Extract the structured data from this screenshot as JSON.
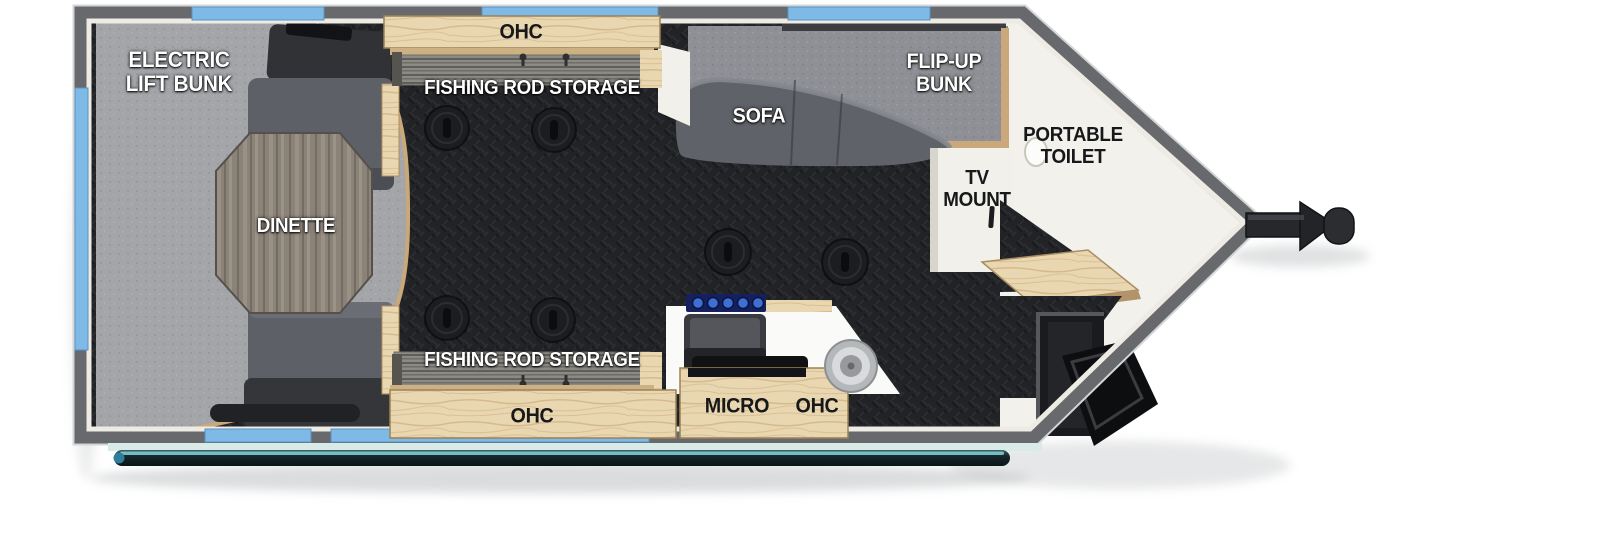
{
  "meta": {
    "type": "rv-floorplan",
    "description": "Top-down floor plan of a V-nose fish house travel trailer with hitch at right"
  },
  "labels": {
    "electric_lift_bunk": {
      "line1": "ELECTRIC",
      "line2": "LIFT BUNK"
    },
    "ohc_top": "OHC",
    "fishing_rod_storage_top": "FISHING ROD STORAGE",
    "dinette": "DINETTE",
    "sofa": "SOFA",
    "flip_up_bunk": {
      "line1": "FLIP-UP",
      "line2": "BUNK"
    },
    "tv_mount": {
      "line1": "TV",
      "line2": "MOUNT"
    },
    "portable_toilet": {
      "line1": "PORTABLE",
      "line2": "TOILET"
    },
    "fishing_rod_storage_bottom": "FISHING ROD STORAGE",
    "ohc_bottom": "OHC",
    "micro": "MICRO",
    "ohc_kitchen": "OHC"
  },
  "colors": {
    "wall": "#67696c",
    "window_blue": "#7fb9e6",
    "inner_liner": "#eeebe4",
    "floor_dark": "#222326",
    "cabinet_wood": "#e9d7b2",
    "trim_wood": "#c9a87a",
    "lift_bunk_gray": "#a3a5a9",
    "bench_gray": "#5d6067",
    "sofa_gray": "#5f6268",
    "flip_bunk_gray": "#8e9095",
    "table_wood": "#8b8278",
    "counter_white": "#fafaf8",
    "stove_blue": "#15205e",
    "awning_teal": "#16282c",
    "nose_floor_white": "#f3f1ec"
  },
  "fixtures": {
    "fishing_holes": 6,
    "windows_top": 3,
    "windows_bottom": 2,
    "windows_side": 1
  }
}
